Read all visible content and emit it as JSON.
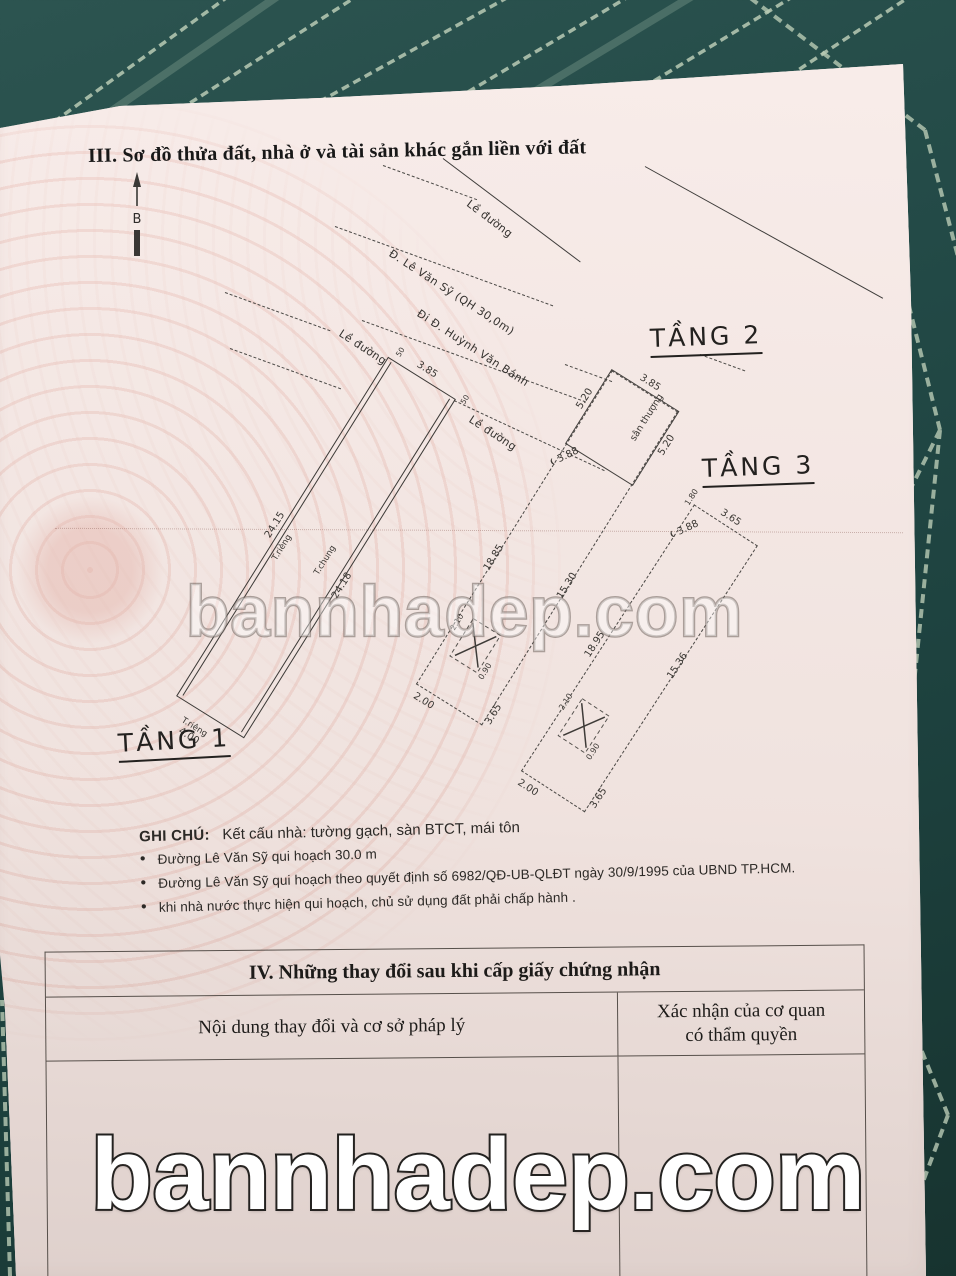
{
  "document": {
    "section3_title": "III. Sơ đồ thửa đất, nhà ở và tài sản khác gắn liền với đất",
    "north_marker": "B"
  },
  "streets": {
    "curb_top": "Lề đường",
    "main_road": "Đ. Lê Văn Sỹ (QH 30,0m)",
    "to_road": "Đi Đ. Huỳnh Văn Bánh",
    "curb_left": "Lề đường",
    "curb_front": "Lề đường"
  },
  "plans": {
    "floor1": {
      "label": "TẦNG 1",
      "front_width": "3.85",
      "wall_tick_left": "50",
      "wall_tick_right": "50",
      "side_left": "24.15",
      "side_left_wall": "T.riêng",
      "side_right_wall": "T.chung",
      "side_right": "24.18",
      "rear_wall": "T.riêng",
      "rear_width": "4.00"
    },
    "floor2": {
      "label": "TẦNG 2",
      "front_width": "3.85",
      "terrace_label": "sân thượng",
      "terrace_left": "5.20",
      "terrace_right": "5.20",
      "house_width": "3.88",
      "side_left": "18.85",
      "side_right": "15.30",
      "stair_len": "2.10",
      "stair_wid": "0.90",
      "rear_width": "2.00",
      "rear_side": "3.65"
    },
    "floor3": {
      "label": "TẦNG 3",
      "front_width": "3.65",
      "front_tick": "1.80",
      "house_width": "3.88",
      "side_left": "18.95",
      "side_right": "15.36",
      "stair_len": "2.10",
      "stair_wid": "0.90",
      "rear_width": "2.00",
      "rear_side": "3.65"
    }
  },
  "notes": {
    "heading": "GHI CHÚ:",
    "structure": "Kết cấu nhà: tường gạch, sàn BTCT, mái tôn",
    "bullets": [
      "Đường Lê Văn Sỹ qui hoạch 30.0 m",
      "Đường Lê Văn Sỹ qui hoạch theo quyết định số 6982/QĐ-UB-QLĐT ngày 30/9/1995 của UBND TP.HCM.",
      "khi nhà nước thực hiện qui hoạch, chủ sử dụng đất phải chấp hành ."
    ]
  },
  "section4": {
    "title": "IV. Những thay đổi sau khi cấp giấy chứng nhận",
    "col_content": "Nội dung thay đổi và cơ sở pháp lý",
    "col_confirm_line1": "Xác nhận của cơ quan",
    "col_confirm_line2": "có thẩm quyền"
  },
  "watermark": {
    "text": "bannhadep.com"
  }
}
